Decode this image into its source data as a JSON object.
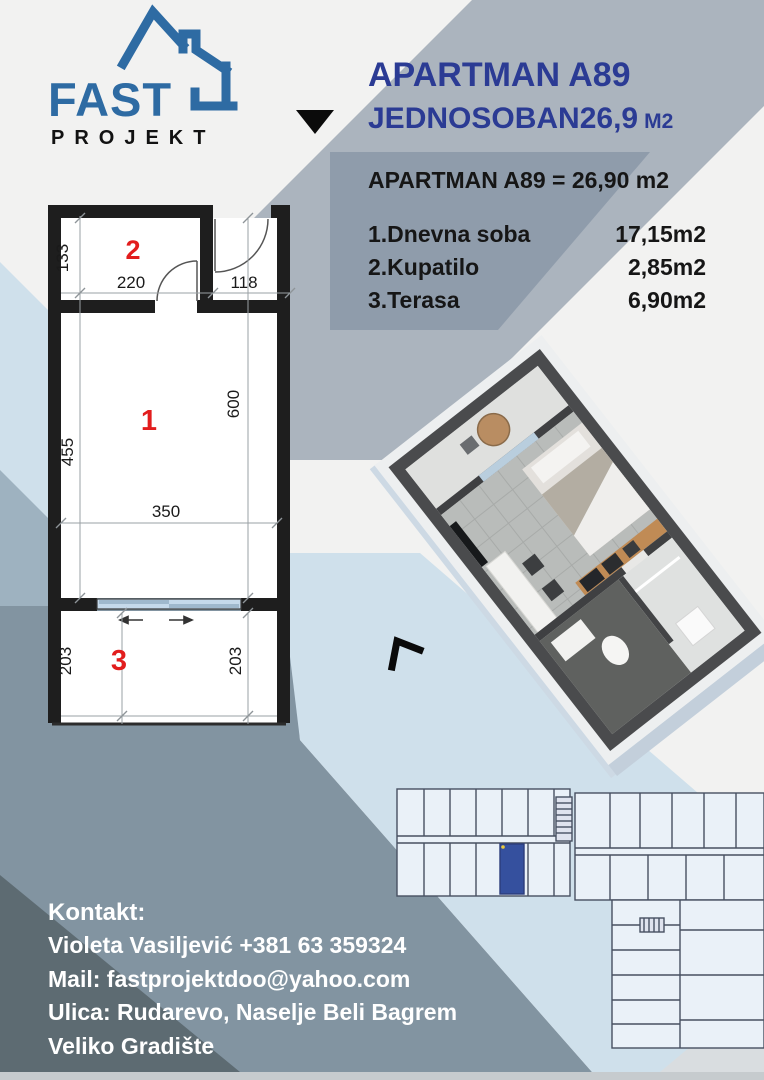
{
  "logo": {
    "name": "FAST",
    "sub": "PROJEKT"
  },
  "header": {
    "title": "APARTMAN A89",
    "subtitle": "JEDNOSOBAN26,9",
    "unit": "M2"
  },
  "summary": {
    "heading": "APARTMAN A89 = 26,90 m2",
    "rows": [
      {
        "label": "1.Dnevna soba",
        "value": "17,15m2"
      },
      {
        "label": "2.Kupatilo",
        "value": "2,85m2"
      },
      {
        "label": "3.Terasa",
        "value": "6,90m2"
      }
    ]
  },
  "floorplan": {
    "room_numbers": {
      "living": "1",
      "bathroom": "2",
      "terrace": "3"
    },
    "dims": {
      "bath_height": "133",
      "bath_width": "220",
      "entry_width": "118",
      "living_left": "455",
      "living_right": "600",
      "living_width": "350",
      "terrace_left": "203",
      "terrace_right": "203"
    }
  },
  "contact": {
    "heading": "Kontakt:",
    "lines": [
      "Violeta Vasiljević +381 63 359324",
      "Mail: fastprojektdoo@yahoo.com",
      "Ulica: Rudarevo, Naselje Beli Bagrem",
      "Veliko Gradište"
    ]
  },
  "colors": {
    "title_blue": "#2b3b94",
    "logo_blue": "#2e6ba3",
    "room_number_red": "#e21d1d",
    "unit_highlight_blue": "#35509e"
  }
}
